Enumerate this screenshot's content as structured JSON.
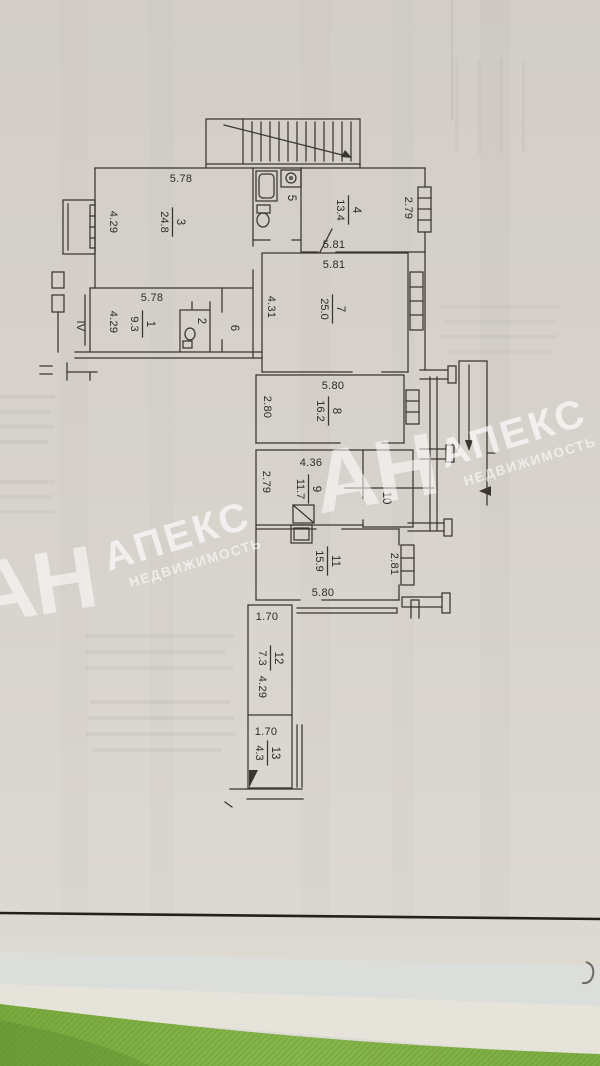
{
  "plan": {
    "entrance_label": "IV",
    "rooms": [
      {
        "number": "1",
        "area": "9.3"
      },
      {
        "number": "2",
        "area": ""
      },
      {
        "number": "3",
        "area": "24.8"
      },
      {
        "number": "4",
        "area": "13.4"
      },
      {
        "number": "5",
        "area": ""
      },
      {
        "number": "6",
        "area": ""
      },
      {
        "number": "7",
        "area": "25.0"
      },
      {
        "number": "8",
        "area": "16.2"
      },
      {
        "number": "9",
        "area": "11.7"
      },
      {
        "number": "10",
        "area": ""
      },
      {
        "number": "11",
        "area": "15.9"
      },
      {
        "number": "12",
        "area": "7.3"
      },
      {
        "number": "13",
        "area": "4.3"
      }
    ],
    "dims": [
      "5.78",
      "4.29",
      "2.79",
      "5.81",
      "5.81",
      "4.31",
      "5.78",
      "4.29",
      "5.80",
      "2.80",
      "4.36",
      "2.79",
      "5.80",
      "2.81",
      "1.70",
      "4.29",
      "1.70"
    ]
  },
  "watermark": {
    "initials": "АН",
    "name": "АПЕКС",
    "subtitle": "НЕДВИЖИМОСТЬ",
    "color": "#ffffff"
  },
  "colors": {
    "paper": "#d6d2cb",
    "ink": "#2e2b25",
    "background_fabric_green": "#7fae44"
  }
}
